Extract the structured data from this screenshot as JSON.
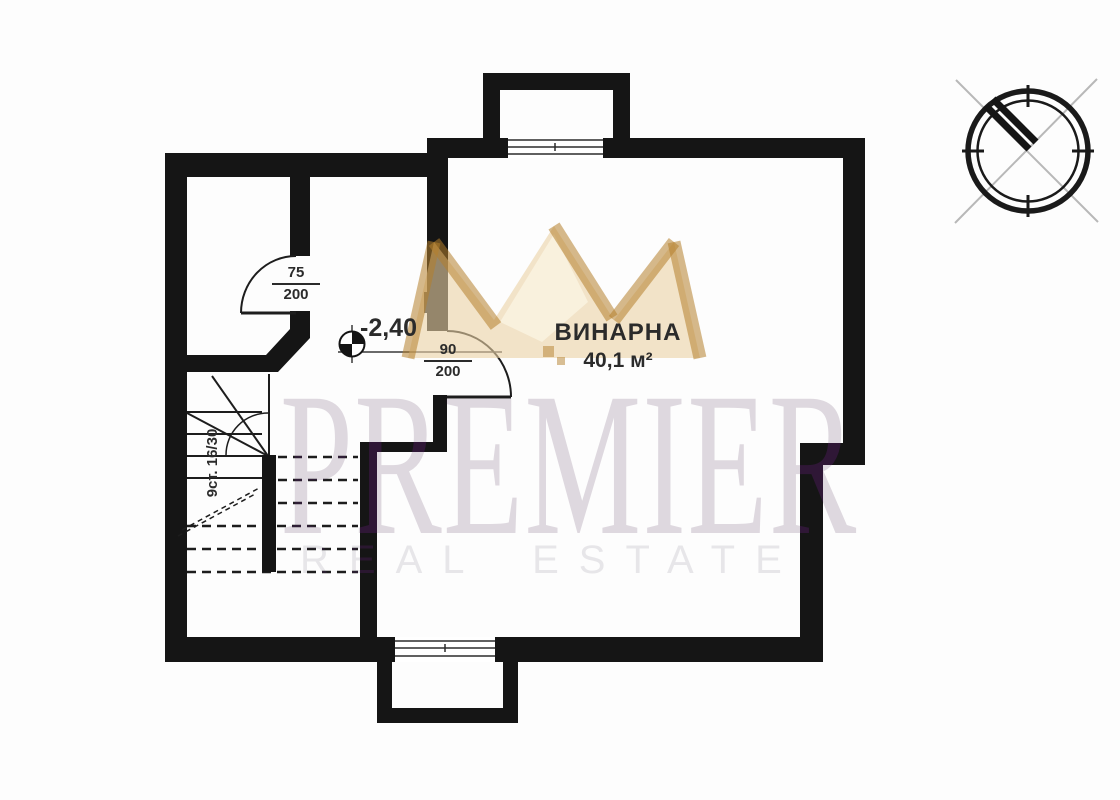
{
  "watermark": {
    "brand": "PREMIER",
    "tagline": "REAL ESTATE"
  },
  "room": {
    "name": "ВИНАРНА",
    "area": "40,1 м²"
  },
  "level_marker": {
    "value": "-2,40"
  },
  "doors": {
    "door1": {
      "width": "75",
      "height": "200"
    },
    "door2": {
      "width": "90",
      "height": "200"
    }
  },
  "stairs": {
    "label": "9ст. 16/30"
  },
  "colors": {
    "wall": "#151515",
    "line": "#1d1d1d",
    "crown_gold": "#b4802c",
    "crown_pale": "#ebd2a5",
    "watermark_purple": "#2f1136",
    "compass_gray": "#b8b8b8"
  }
}
